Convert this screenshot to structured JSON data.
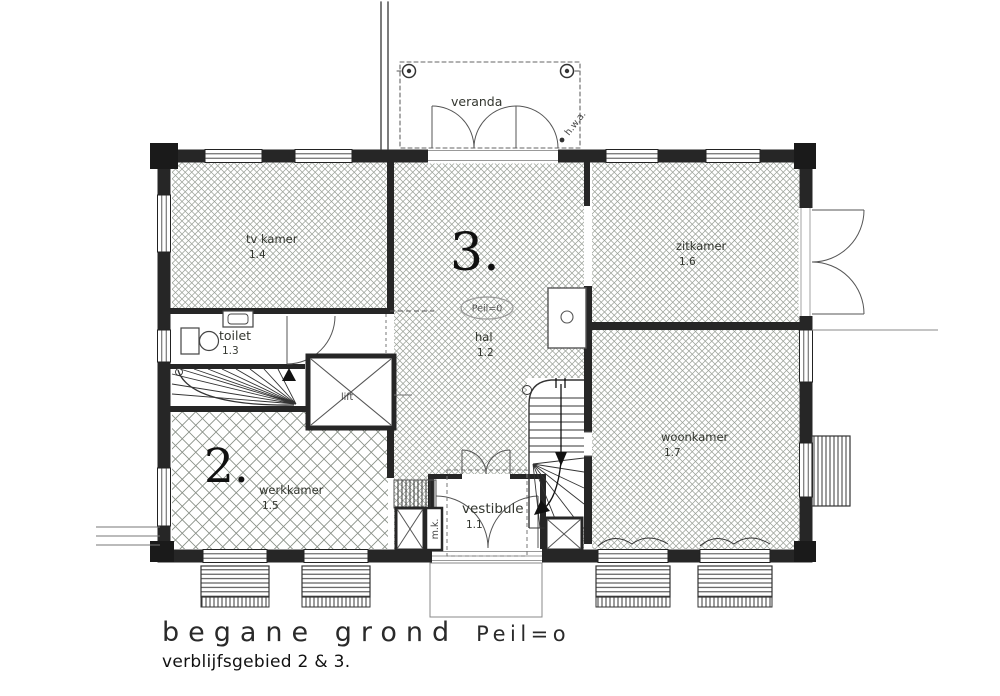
{
  "drawing": {
    "caption": {
      "title": "begane grond",
      "level": "Peil=o",
      "sub": "verblijfsgebied 2 & 3."
    },
    "area_numbers": {
      "two": "2.",
      "three": "3."
    },
    "peil_marker": "Peil=0",
    "veranda_label": "veranda",
    "hwa_label": "h.w.a.",
    "lift_label": "lift",
    "mk_label": "m.k.",
    "rooms": {
      "vestibule": {
        "name": "vestibule",
        "number": "1.1"
      },
      "hal": {
        "name": "hal",
        "number": "1.2"
      },
      "toilet": {
        "name": "toilet",
        "number": "1.3"
      },
      "tvkamer": {
        "name": "tv kamer",
        "number": "1.4"
      },
      "werkkamer": {
        "name": "werkkamer",
        "number": "1.5"
      },
      "zitkamer": {
        "name": "zitkamer",
        "number": "1.6"
      },
      "woonkamer": {
        "name": "woonkamer",
        "number": "1.7"
      }
    },
    "colors": {
      "ink": "#262626",
      "hatch": "#9aa198",
      "paper": "#ffffff"
    }
  }
}
